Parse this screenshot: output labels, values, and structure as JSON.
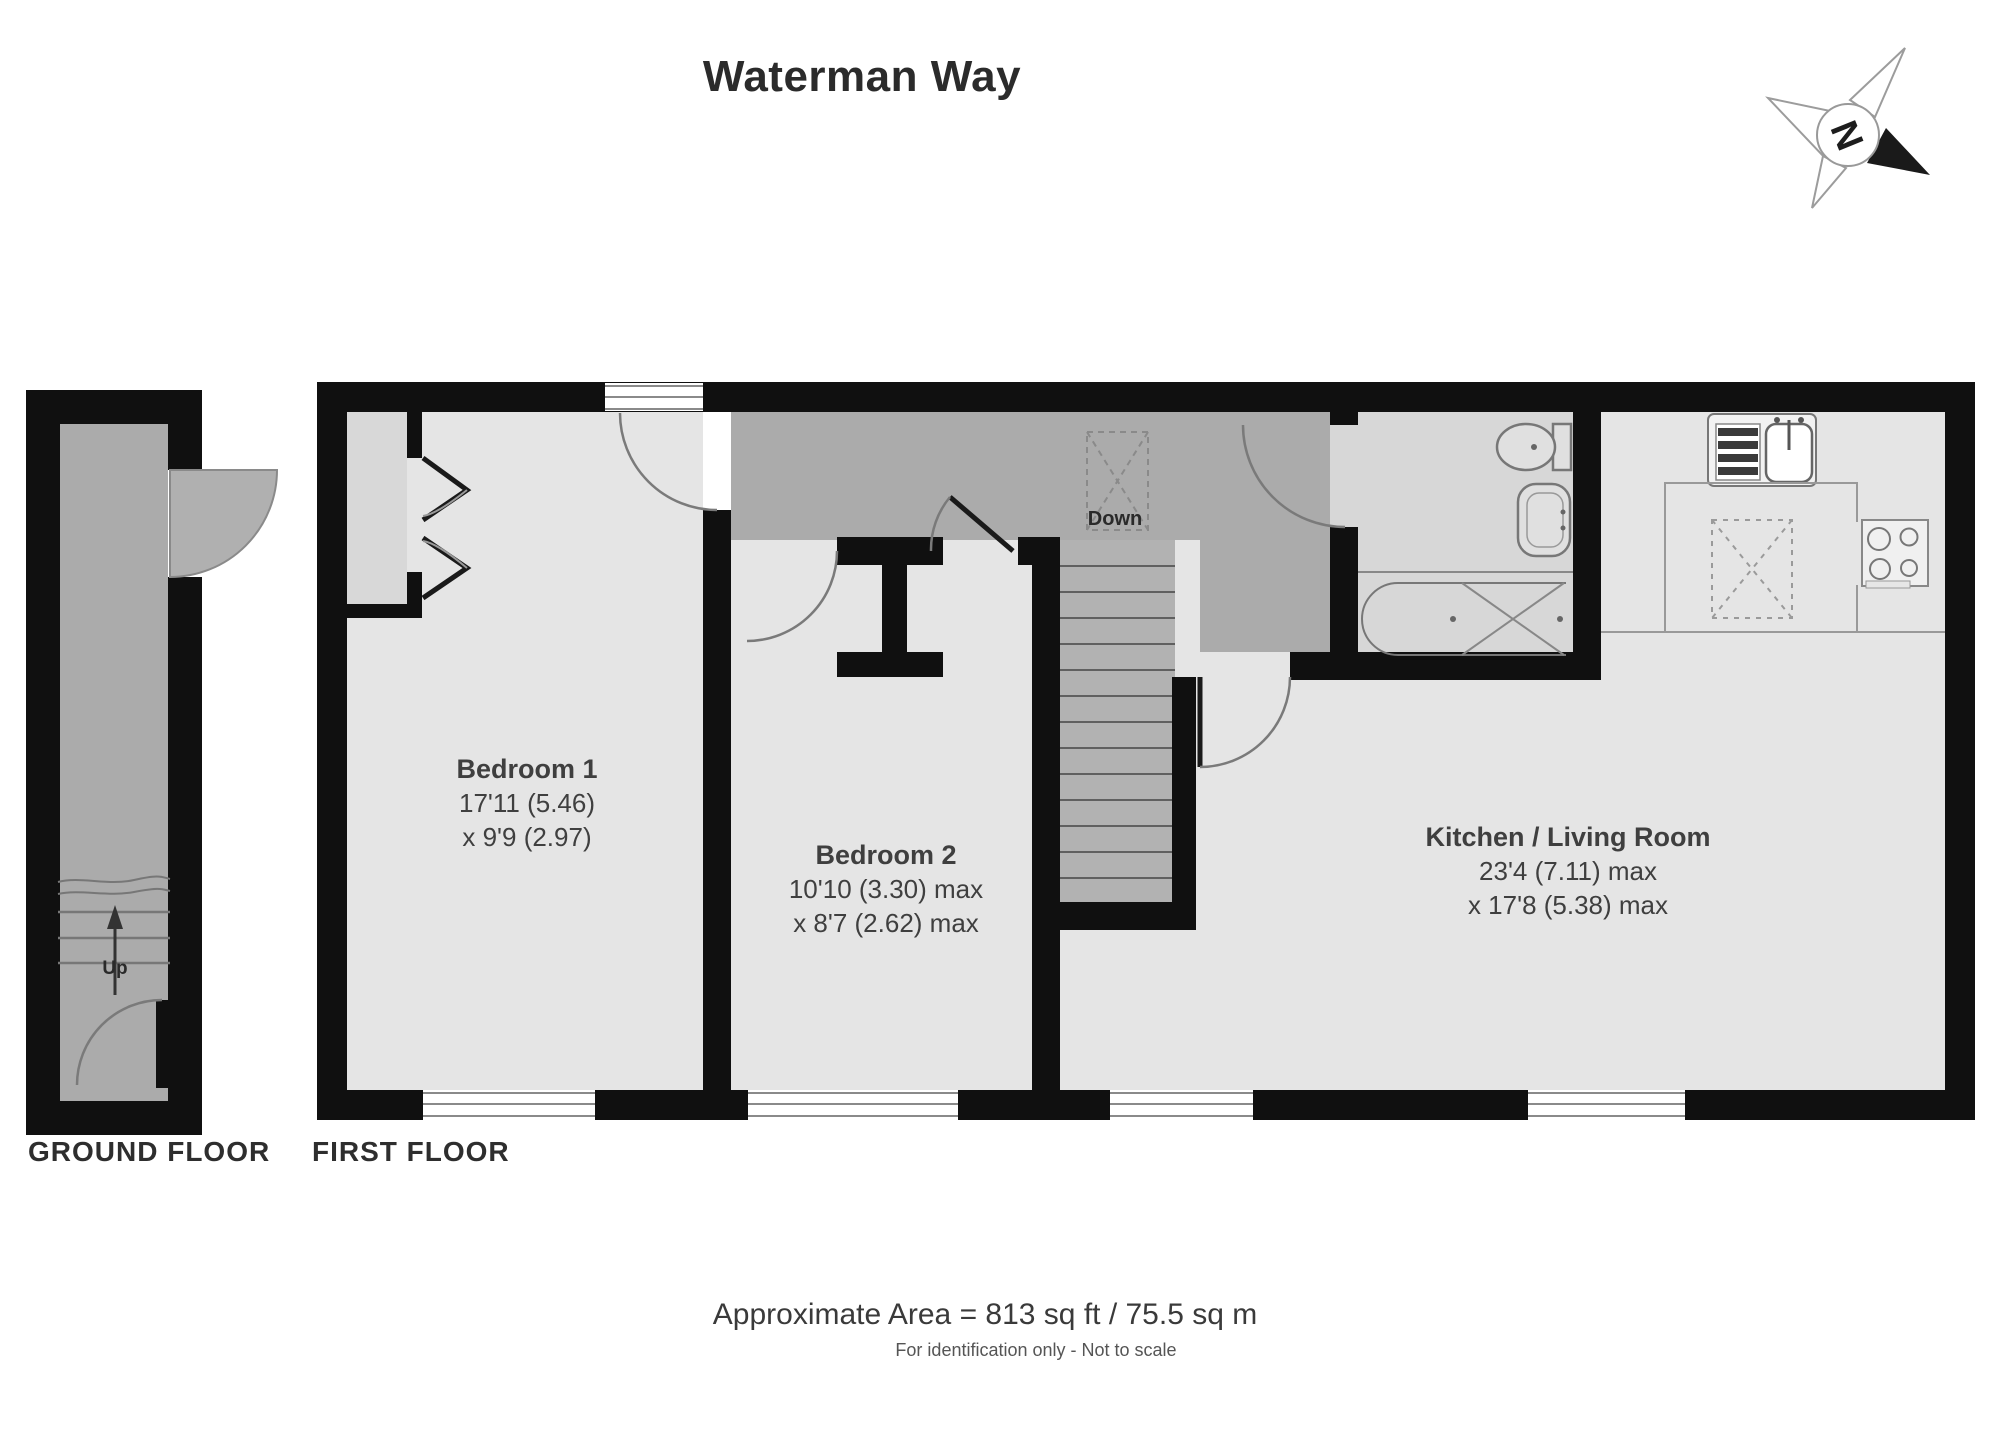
{
  "title": "Waterman Way",
  "compass": {
    "north_label": "N"
  },
  "floors": {
    "ground": {
      "label": "GROUND FLOOR",
      "stairs_label": "Up"
    },
    "first": {
      "label": "FIRST FLOOR",
      "stairs_label": "Down"
    }
  },
  "rooms": {
    "bedroom1": {
      "name": "Bedroom 1",
      "dim1": "17'11 (5.46)",
      "dim2": "x 9'9 (2.97)"
    },
    "bedroom2": {
      "name": "Bedroom 2",
      "dim1": "10'10 (3.30) max",
      "dim2": "x 8'7 (2.62) max"
    },
    "kitchen_living": {
      "name": "Kitchen / Living Room",
      "dim1": "23'4 (7.11) max",
      "dim2": "x 17'8 (5.38) max"
    }
  },
  "footer": {
    "area_label": "Approximate Area = 813 sq ft / 75.5 sq m",
    "disclaimer": "For identification only - Not to scale"
  },
  "colors": {
    "wall": "#101010",
    "room_fill": "#e5e5e5",
    "hall_fill": "#ababab",
    "stairs_fill": "#b2b2b2",
    "bathroom_fill": "#d7d7d7",
    "line": "#7a7a7a"
  }
}
